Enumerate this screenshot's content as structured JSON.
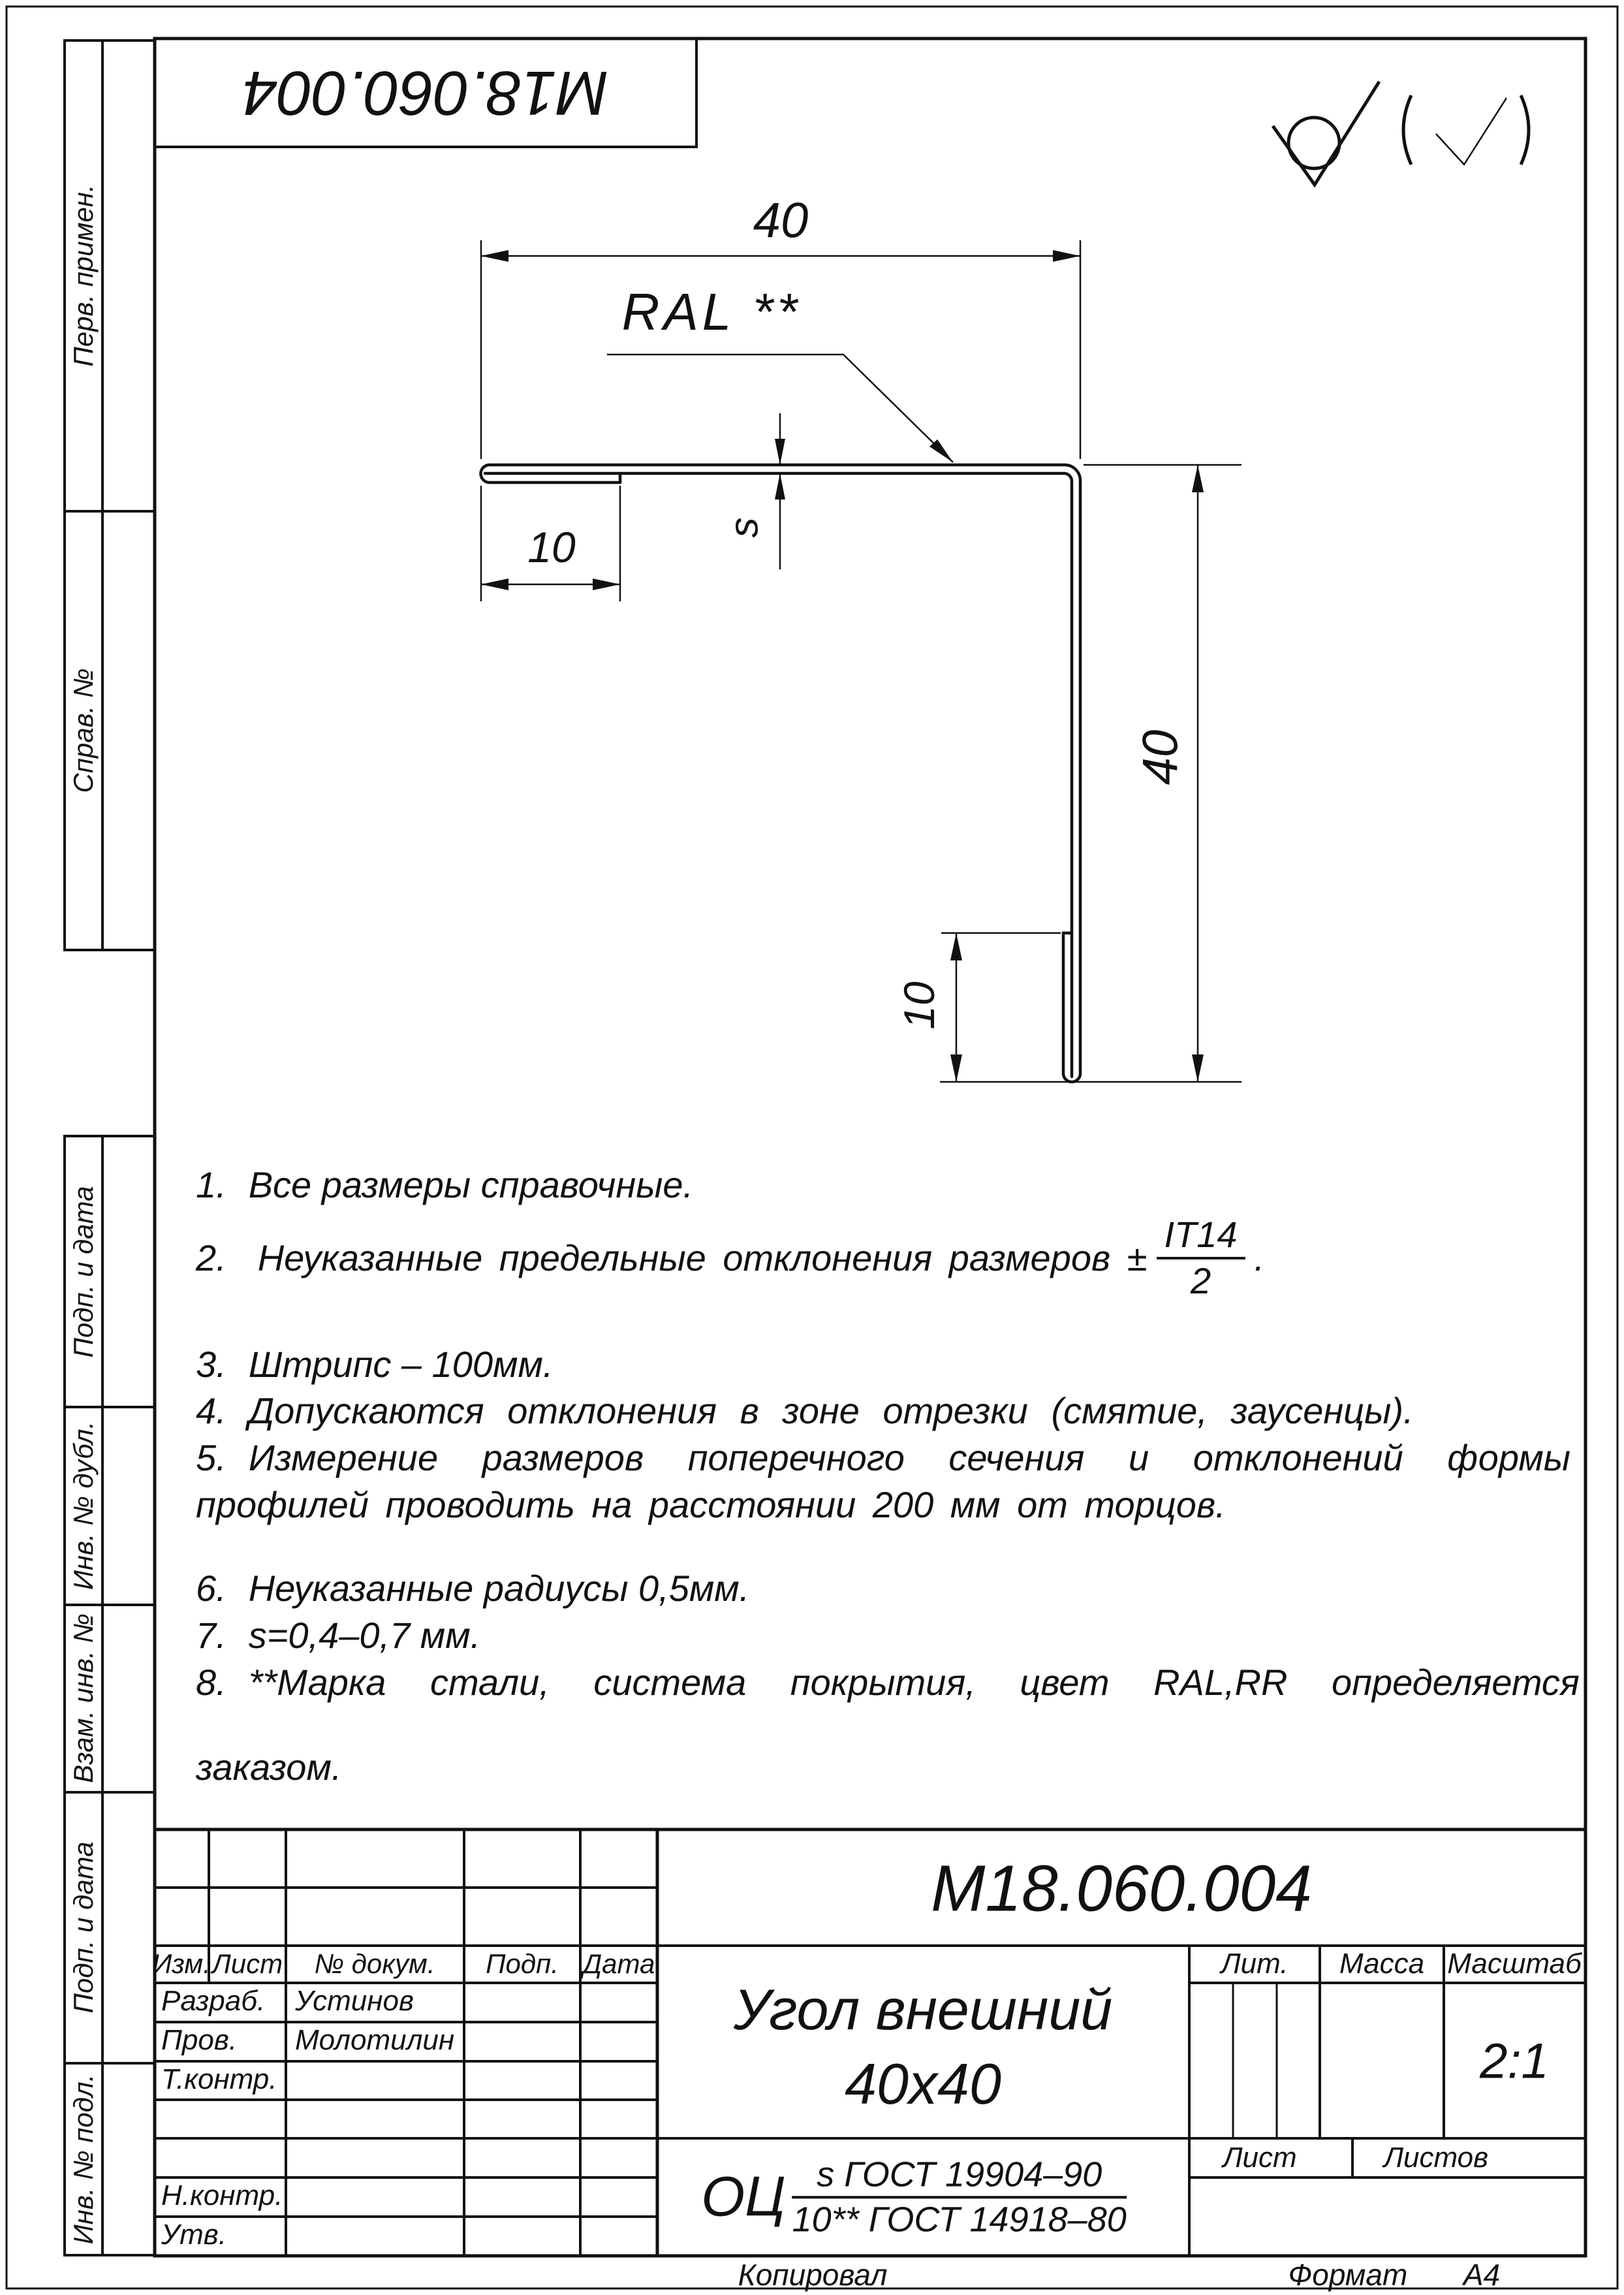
{
  "page": {
    "copied_label": "Копировал",
    "format_label": "Формат",
    "format_value": "А4"
  },
  "code_stamp": "М18.060.004",
  "margin_labels": [
    "Перв. примен.",
    "Справ. №",
    "Подп. и дата",
    "Инв. № дубл.",
    "Взам. инв. №",
    "Подп. и дата",
    "Инв. № подл."
  ],
  "icons": {
    "surface_finish": "check-with-circle (обработка без удаления материала)",
    "surface_finish_bracket": "(check) остальные поверхности"
  },
  "drawing": {
    "label_ral": "RAL **",
    "dim_top": "40",
    "dim_hem_top": "10",
    "dim_thickness": "s",
    "dim_right": "40",
    "dim_hem_bottom": "10"
  },
  "notes": {
    "n1": {
      "num": "1.",
      "text": "Все размеры справочные."
    },
    "n2": {
      "num": "2.",
      "pre": "Неуказанные предельные отклонения размеров ±",
      "frac_num": "IT14",
      "frac_den": "2",
      "post": "."
    },
    "n3": {
      "num": "3.",
      "text": "Штрипс – 100мм."
    },
    "n4": {
      "num": "4.",
      "text": "Допускаются отклонения в зоне отрезки (смятие, заусенцы)."
    },
    "n5": {
      "num": "5.",
      "line1": "Измерение размеров поперечного сечения и отклонений формы",
      "line2": "профилей проводить на расстоянии 200 мм от торцов."
    },
    "n6": {
      "num": "6.",
      "text": "Неуказанные радиусы 0,5мм."
    },
    "n7": {
      "num": "7.",
      "text": "s=0,4–0,7 мм."
    },
    "n8": {
      "num": "8.",
      "line1": "**Марка стали, система покрытия, цвет RAL,RR определяется",
      "line2": "заказом."
    }
  },
  "title_block": {
    "designation": "М18.060.004",
    "name_line1": "Угол внешний",
    "name_line2": "40х40",
    "material_prefix": "ОЦ",
    "material_num": "s ГОСТ 19904–90",
    "material_den": "10** ГОСТ 14918–80",
    "headers": {
      "izm": "Изм.",
      "list": "Лист",
      "doc": "№ докум.",
      "podp": "Подп.",
      "data": "Дата"
    },
    "rows": {
      "razrab": "Разраб.",
      "prov": "Пров.",
      "tkontr": "Т.контр.",
      "nkontr": "Н.контр.",
      "utv": "Утв."
    },
    "people": {
      "razrab": "Устинов",
      "prov": "Молотилин"
    },
    "lit_label": "Лит.",
    "mass_label": "Масса",
    "scale_label": "Масштаб",
    "scale_value": "2:1",
    "sheet_label": "Лист",
    "sheets_label": "Листов"
  }
}
